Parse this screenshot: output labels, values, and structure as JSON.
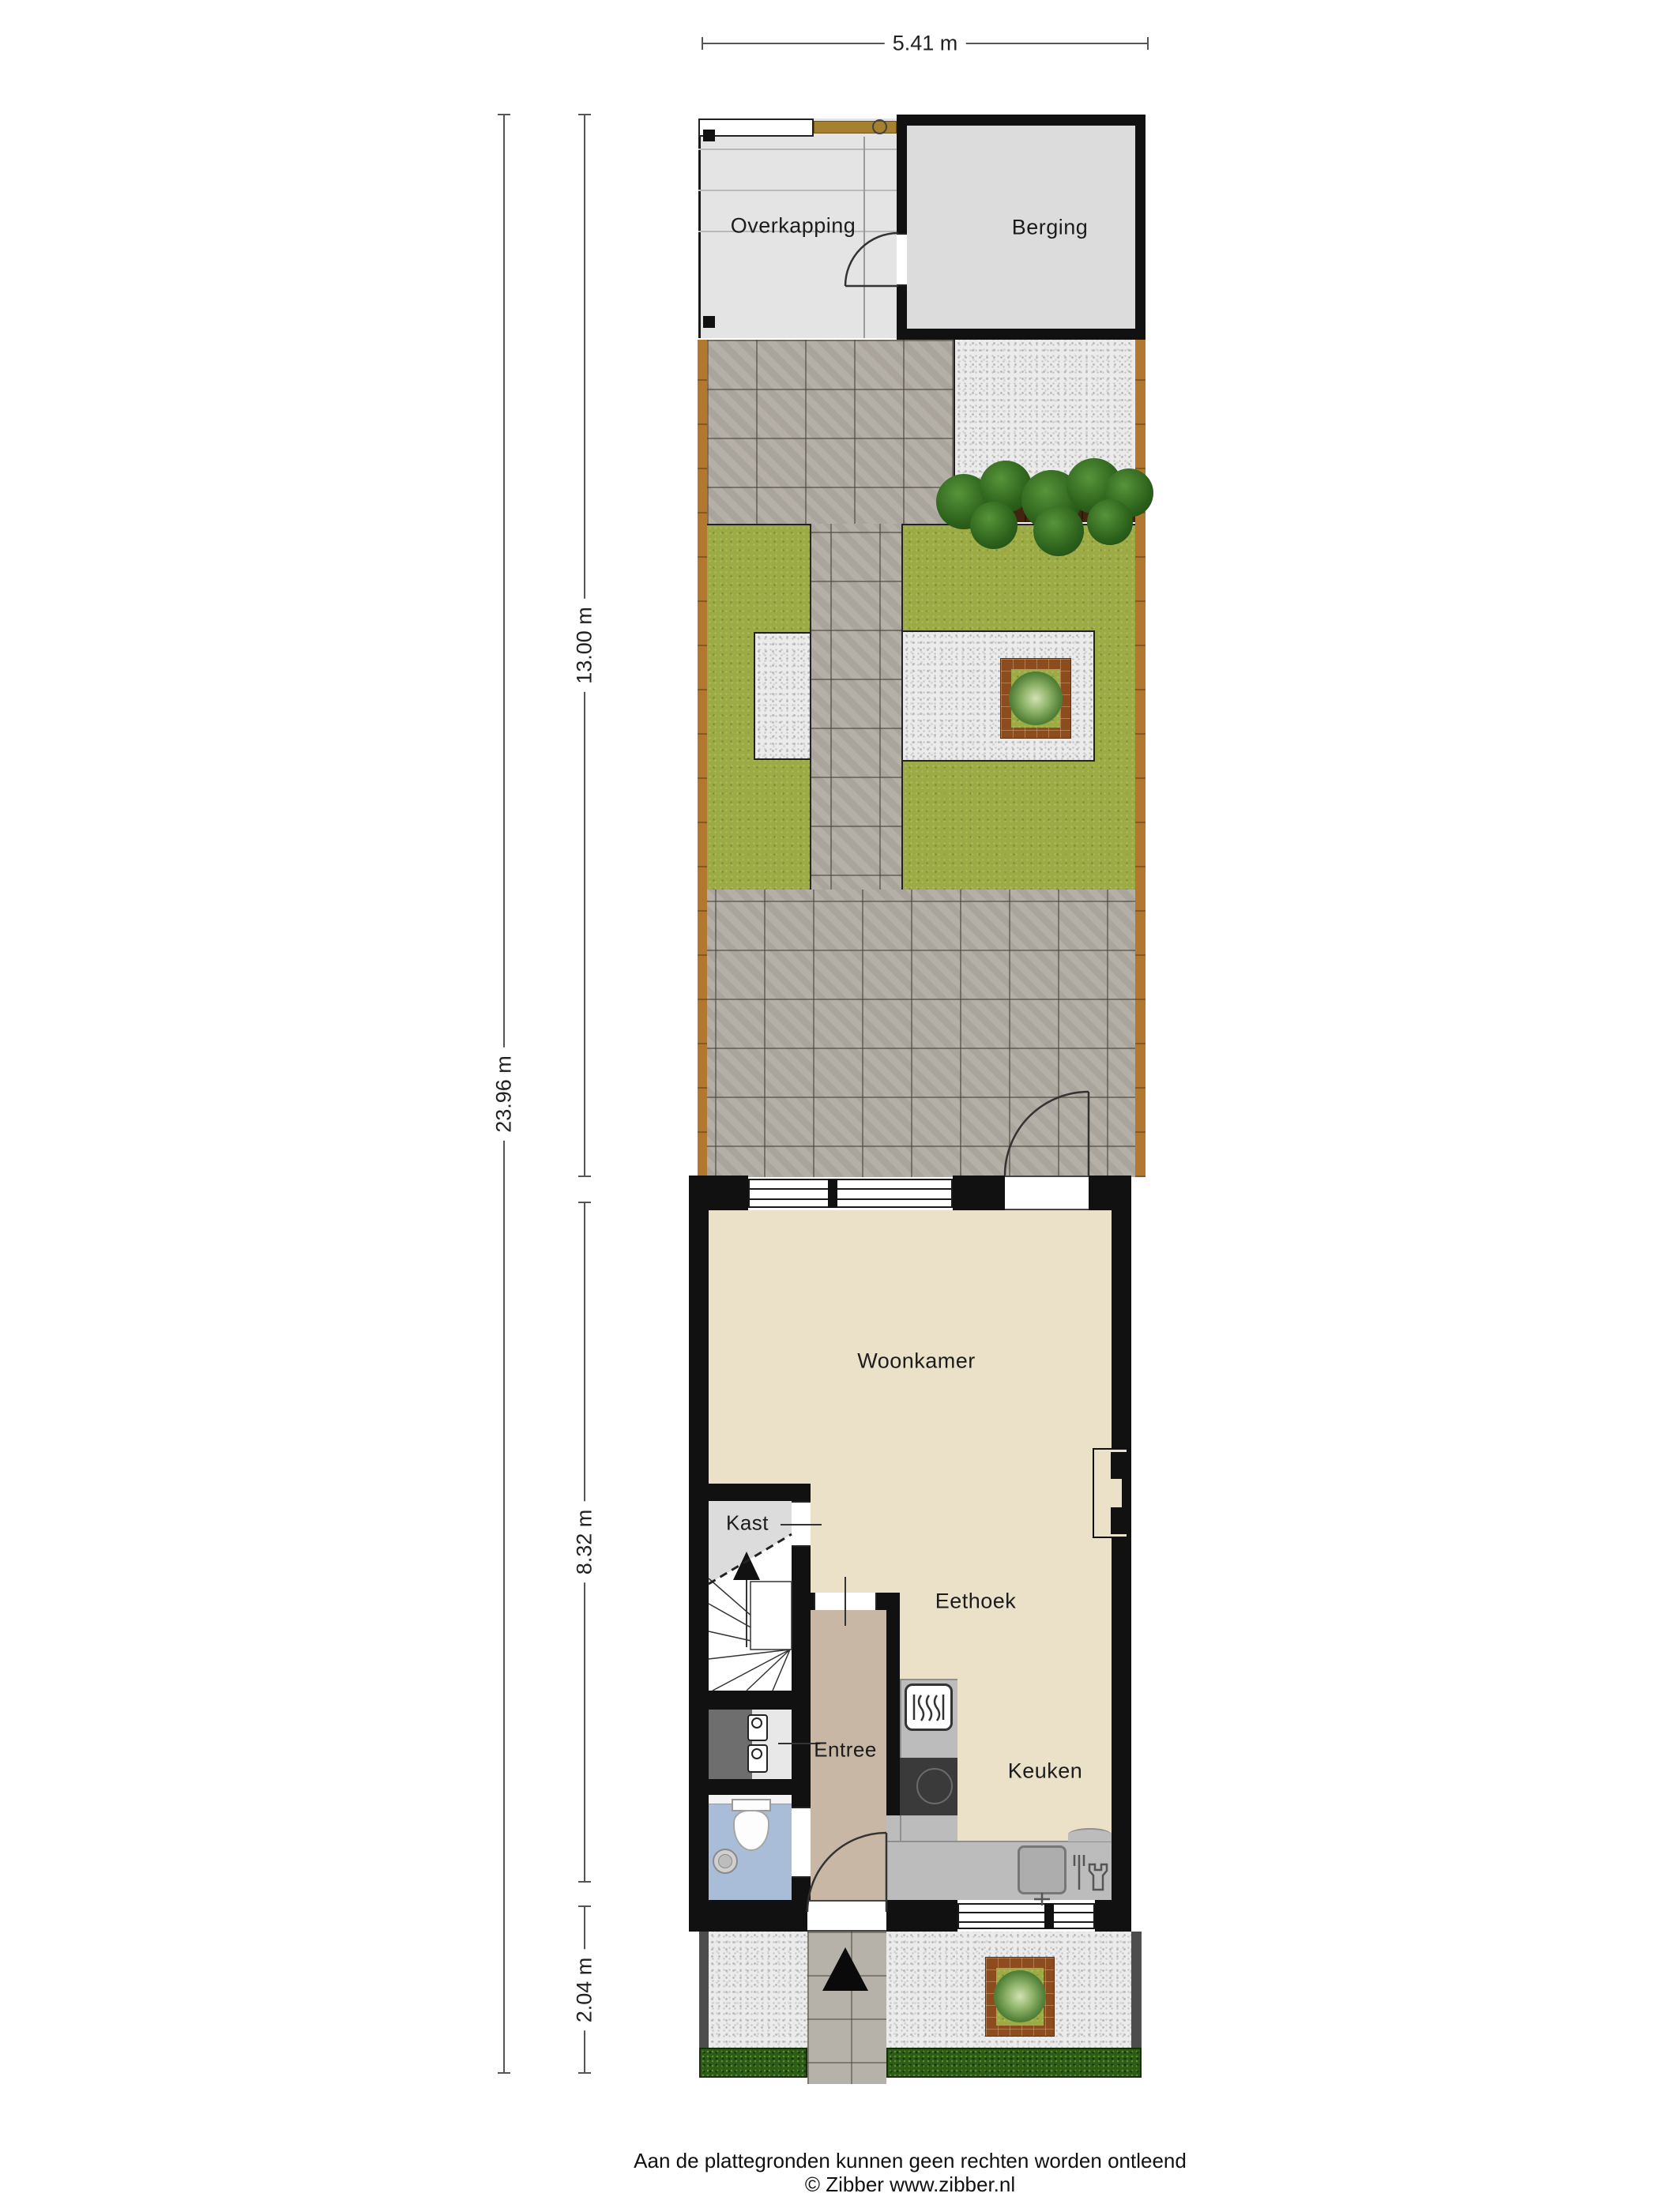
{
  "plan": {
    "type": "floor-plan-with-garden",
    "rooms": {
      "overkapping": "Overkapping",
      "berging": "Berging",
      "woonkamer": "Woonkamer",
      "kast": "Kast",
      "eethoek": "Eethoek",
      "entree": "Entree",
      "keuken": "Keuken"
    },
    "dimensions": {
      "width_total": "5.41 m",
      "depth_total": "23.96 m",
      "depth_backyard": "13.00 m",
      "depth_house": "8.32 m",
      "depth_front_yard": "2.04 m"
    },
    "icons": [
      "entrance-arrow-icon",
      "stairs-up-arrow-icon",
      "oven-icon",
      "cooktop-icon",
      "sink-icon",
      "dishwasher-icon",
      "toilet-icon",
      "washbasin-icon",
      "meter-box-icon",
      "plant-icon",
      "shrub-icon",
      "door-swing-icon"
    ],
    "colors": {
      "wall": "#111111",
      "tile": "#b0aba2",
      "gravel": "#ebebeb",
      "grass": "#9dab44",
      "hedge": "#2d5c17",
      "fence": "#b2782f",
      "planter": "#8d4c1d",
      "floor_cream": "#eae1c8",
      "floor_entree": "#c8b7a4",
      "floor_toilet": "#a9bdd8",
      "floor_closet": "#dcdcdc",
      "counter": "#bcbcbc",
      "cooktop": "#3a3a3a"
    }
  },
  "footer": {
    "line1": "Aan de plattegronden kunnen geen rechten worden ontleend",
    "line2": "© Zibber www.zibber.nl"
  }
}
